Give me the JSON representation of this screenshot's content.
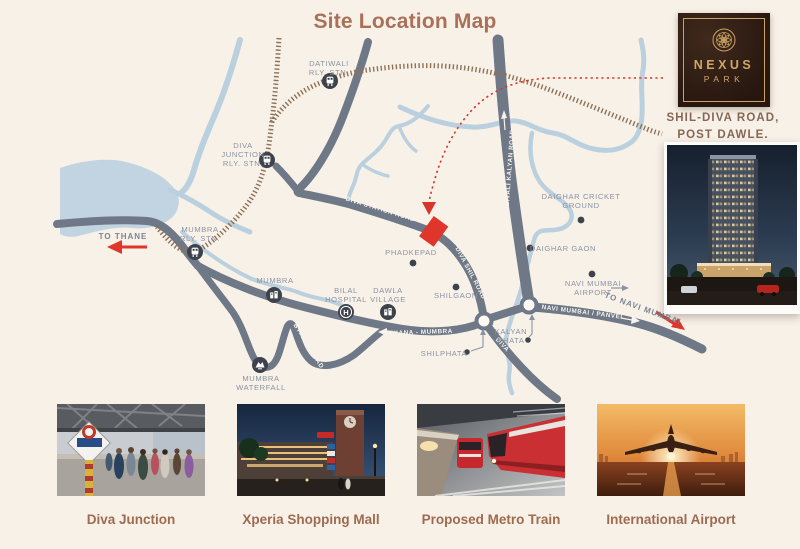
{
  "title": "Site Location Map",
  "logo": {
    "brand_1": "NEXUS",
    "brand_2": "PARK"
  },
  "address": {
    "line1": "SHIL-DIVA ROAD,",
    "line2": "POST DAWLE."
  },
  "map": {
    "labels": {
      "to_thane": "TO THANE",
      "dativali_1": "DATIWALI",
      "dativali_2": "RLY. STN.",
      "diva_jn_1": "DIVA",
      "diva_jn_2": "JUNCTION",
      "diva_jn_3": "RLY. STN.",
      "mumbra_stn_1": "MUMBRA",
      "mumbra_stn_2": "RLY. STN.",
      "mumbra_village": "MUMBRA",
      "bilal_1": "BILAL",
      "bilal_2": "HOSPITAL",
      "dawla_1": "DAWLA",
      "dawla_2": "VILLAGE",
      "phadkepad": "PHADKEPAD",
      "shilgaon": "SHILGAON",
      "daighar_cricket_1": "DAIGHAR CRICKET",
      "daighar_cricket_2": "GROUND",
      "daighar_gaon": "DAIGHAR GAON",
      "airport_1": "NAVI MUMBAI",
      "airport_2": "AIRPORT",
      "kalyan_1": "KALYAN",
      "kalyan_2": "PHATA",
      "shilphata": "SHILPHATA",
      "waterfall_1": "MUMBRA",
      "waterfall_2": "WATERFALL",
      "to_navi_mumbai": "TO NAVI MUMBAI"
    },
    "road_labels": {
      "diva_station_road": "DIVA STATION ROAD",
      "diva_shil_road": "DIVA SHIL ROAD",
      "dombivali_kalyan_road": "DOMBIVALI KALYAN ROAD",
      "thana_mumbra": "THANA - MUMBRA",
      "navi_mumbai_panvel": "NAVI MUMBAI / PANVEL",
      "bypass_road": "BYPASS ROAD",
      "diva": "DIVA"
    }
  },
  "gallery": [
    {
      "caption": "Diva Junction"
    },
    {
      "caption": "Xperia Shopping Mall"
    },
    {
      "caption": "Proposed Metro Train"
    },
    {
      "caption": "International Airport"
    }
  ],
  "colors": {
    "red": "#e0352b",
    "road": "#6f7887",
    "railway": "#8d7257",
    "river": "#bad0de",
    "gold": "#c9a264",
    "title_brown": "#aa7058",
    "label_gray": "#8a93a4",
    "background": "#f8f1e8"
  }
}
